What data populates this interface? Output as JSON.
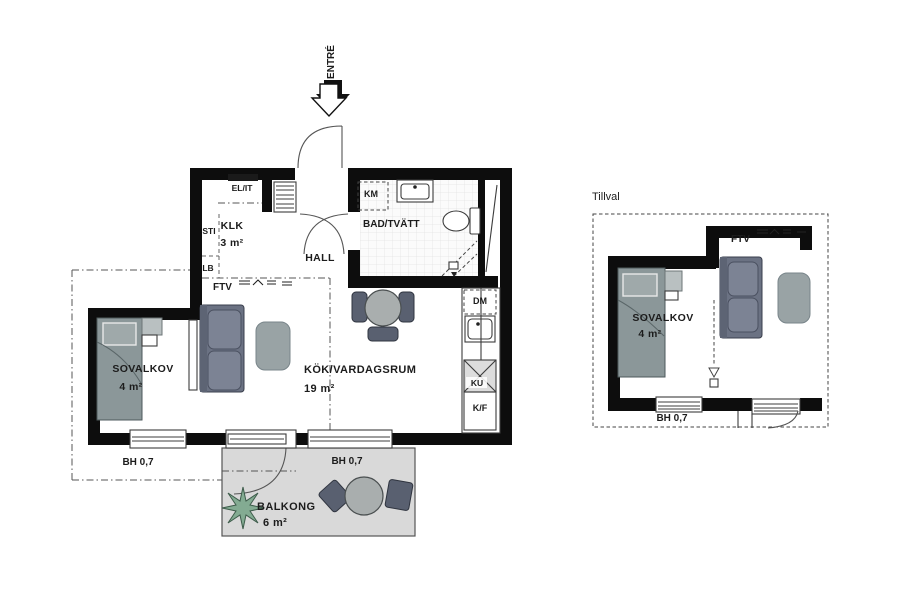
{
  "plan": {
    "entry_label": "ENTRÉ",
    "rooms": {
      "klk": {
        "name": "KLK",
        "area": "3 m²"
      },
      "hall": {
        "name": "HALL"
      },
      "bath": {
        "name": "BAD/TVÄTT"
      },
      "kitchen_living": {
        "name": "KÖK/VARDAGSRUM",
        "area": "19 m²"
      },
      "alcove": {
        "name": "SOVALKOV",
        "area": "4 m²"
      },
      "balcony": {
        "name": "BALKONG",
        "area": "6 m²"
      }
    },
    "labels": {
      "el_it": "EL/IT",
      "sti": "STI",
      "lb": "LB",
      "ftv": "FTV",
      "km": "KM",
      "dm": "DM",
      "ku": "KU",
      "kf": "K/F",
      "window_left": "BH 0,7",
      "window_right": "BH 0,7"
    }
  },
  "option": {
    "title": "Tillval",
    "rooms": {
      "alcove": {
        "name": "SOVALKOV",
        "area": "4 m²"
      }
    },
    "labels": {
      "ftv": "FTV",
      "window": "BH 0,7"
    }
  },
  "colors": {
    "wall": "#0d0d0d",
    "bed": "#8b9799",
    "pillow": "#9fa9aa",
    "sofa": "#6b7283",
    "sofa_back": "#5d6474",
    "sofa_cushion": "#7c8394",
    "rug": "#99a3a5",
    "balcony_floor": "#d9d9d9",
    "table": "#a9aeae",
    "chair": "#596070",
    "plant": "#83ab92",
    "side_table": "#b9c0c1"
  }
}
